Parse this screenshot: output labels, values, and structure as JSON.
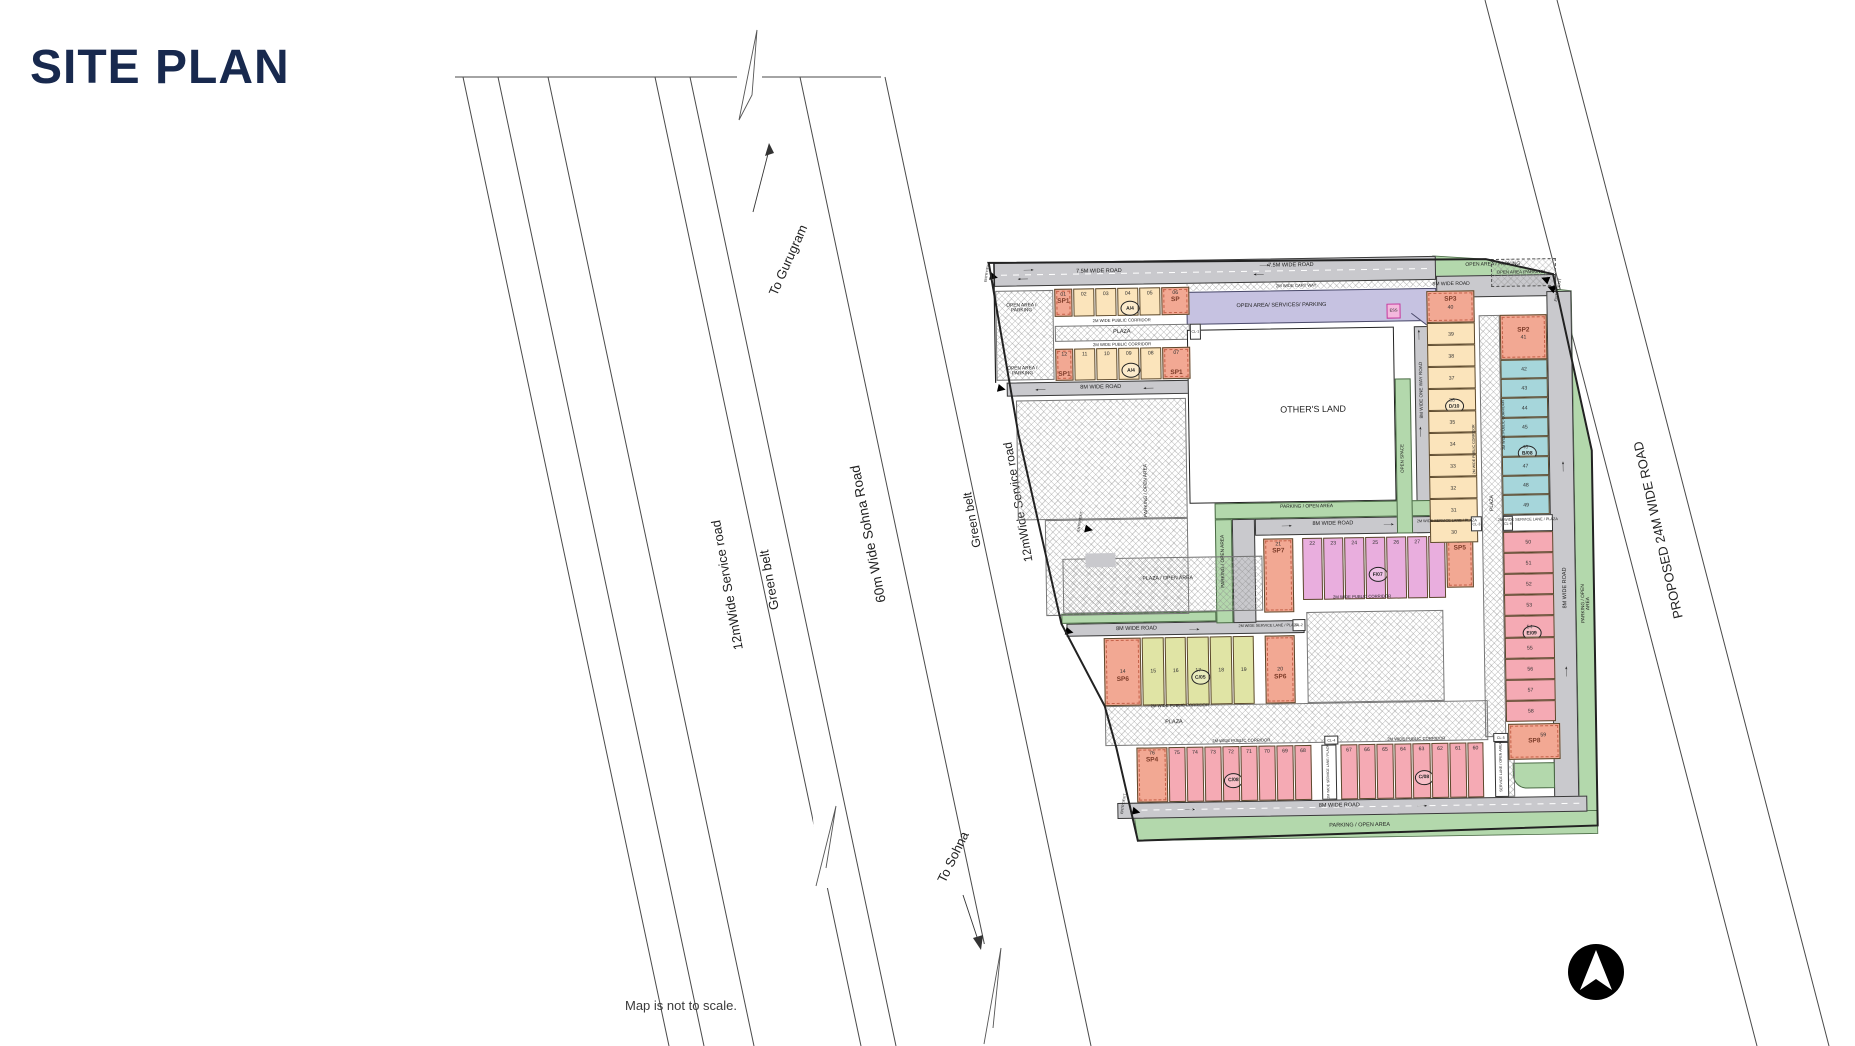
{
  "title": "SITE PLAN",
  "note": "Map is not to scale.",
  "colors": {
    "title_navy": "#18294e",
    "road_gray": "#c9c9cd",
    "green": "#b3d8ac",
    "lavender": "#c6c2e1",
    "cream": "#fbe4bb",
    "salmon": "#f2a893",
    "pink_violet": "#e9aede",
    "rose": "#f5aab4",
    "teal": "#a6d6db",
    "olive": "#e0e4a5",
    "outline": "#2b2b2b"
  },
  "roads_left": {
    "to_gurugram": "To Gurugram",
    "service_road_1": "12mWide Service road",
    "green_belt_1": "Green belt",
    "sohna_road": "60m Wide Sohna Road",
    "green_belt_2": "Green belt",
    "service_road_2": "12mWide Service road",
    "to_sohna": "To Sohna"
  },
  "road_right": {
    "label": "PROPOSED 24M WIDE ROAD"
  },
  "north_icon": "north-arrow",
  "site": {
    "labels": {
      "road_7_5": "7.5M WIDE ROAD",
      "road_8": "8M WIDE ROAD",
      "road_8_oneway": "8M WIDE ONE WAY ROAD",
      "cart_way": "2M WIDE CART WAY",
      "corridor": "2M WIDE PUBLIC CORRIDOR",
      "service_lane_plaza": "2M WIDE SERVICE LANE / PLAZA",
      "service_lane_open": "SERVICE LANE / OPEN AREA",
      "plaza": "PLAZA",
      "plaza_open_area": "PLAZA / OPEN AREA",
      "parking_open_area": "PARKING / OPEN AREA",
      "open_area_parking": "OPEN AREA / PARKING",
      "open_area_parking2": "OPEN AREA /\nPARKING",
      "open_area_parking_br": "OPEN AREA (PARKING)",
      "open_area_services": "OPEN AREA/ SERVICES/ PARKING",
      "open_space": "OPEN SPACE",
      "others_land": "OTHER'S LAND",
      "entry_exit": "ENTRY/EXIT",
      "ess": "ESS",
      "cl": [
        "CL-1",
        "CL-2",
        "CL-3",
        "CL-4",
        "CL-5",
        "CL-6"
      ]
    },
    "rows": {
      "tl_row1": [
        {
          "sp": "SP1",
          "n": "01"
        },
        {
          "n": "02"
        },
        {
          "n": "03"
        },
        {
          "n": "04",
          "c": "A/4"
        },
        {
          "n": "05"
        },
        {
          "sp": "SP",
          "n": "06"
        }
      ],
      "tl_row2": [
        {
          "n": "12",
          "sp": "SP1"
        },
        {
          "n": "11"
        },
        {
          "n": "10"
        },
        {
          "n": "09",
          "c": "A/4"
        },
        {
          "n": "08"
        },
        {
          "n": "07",
          "sp": "SP1"
        }
      ],
      "c05": [
        {
          "sp": "SP6",
          "n": "14"
        },
        {
          "n": "15"
        },
        {
          "n": "16"
        },
        {
          "n": "17",
          "c": "C/05"
        },
        {
          "n": "18"
        },
        {
          "n": "19"
        },
        {
          "sp": "SP6",
          "n": "20"
        }
      ],
      "f07": [
        {
          "sp": "SP7",
          "n": "21"
        },
        {
          "n": "22"
        },
        {
          "n": "23"
        },
        {
          "n": "24"
        },
        {
          "n": "25",
          "c": "F/07"
        },
        {
          "n": "26"
        },
        {
          "n": "27"
        },
        {
          "n": "28"
        },
        {
          "sp": "SP5",
          "n": "29"
        }
      ],
      "d10": [
        {
          "sp": "SP3",
          "n": "40"
        },
        {
          "n": "39"
        },
        {
          "n": "38"
        },
        {
          "n": "37"
        },
        {
          "n": "36",
          "c": "D/10"
        },
        {
          "n": "35"
        },
        {
          "n": "34"
        },
        {
          "n": "33"
        },
        {
          "n": "32"
        },
        {
          "n": "31"
        },
        {
          "n": "30"
        }
      ],
      "teal": [
        {
          "sp": "SP2",
          "n": "41"
        },
        {
          "n": "42"
        },
        {
          "n": "43"
        },
        {
          "n": "44"
        },
        {
          "n": "45"
        },
        {
          "n": "46",
          "c": "B/08"
        },
        {
          "n": "47"
        },
        {
          "n": "48"
        },
        {
          "n": "49"
        }
      ],
      "red": [
        {
          "n": "50"
        },
        {
          "n": "51"
        },
        {
          "n": "52"
        },
        {
          "n": "53"
        },
        {
          "n": "54",
          "c": "E/09"
        },
        {
          "n": "55"
        },
        {
          "n": "56"
        },
        {
          "n": "57"
        },
        {
          "n": "58"
        }
      ],
      "sp8": {
        "sp": "SP8",
        "n": "59"
      },
      "bottom_left": [
        {
          "sp": "SP4",
          "n": "76"
        },
        {
          "n": "75"
        },
        {
          "n": "74"
        },
        {
          "n": "73"
        },
        {
          "n": "72",
          "c": "C/08"
        },
        {
          "n": "71"
        },
        {
          "n": "70"
        },
        {
          "n": "69"
        },
        {
          "n": "68"
        }
      ],
      "bottom_right": [
        {
          "n": "67"
        },
        {
          "n": "66"
        },
        {
          "n": "65"
        },
        {
          "n": "64"
        },
        {
          "n": "63",
          "c": "C/08"
        },
        {
          "n": "62"
        },
        {
          "n": "61"
        },
        {
          "n": "60"
        }
      ]
    }
  }
}
